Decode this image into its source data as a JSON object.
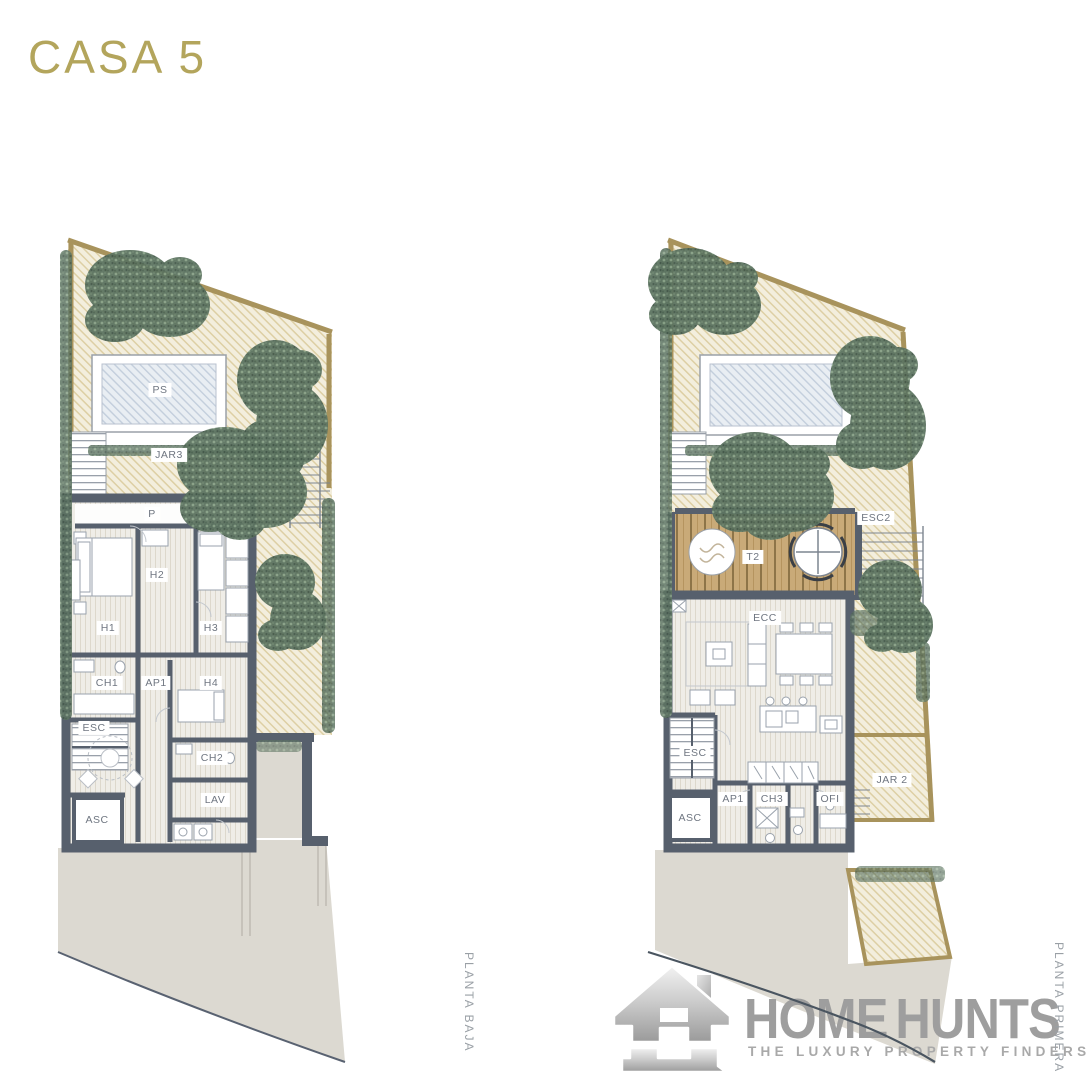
{
  "page": {
    "title": "CASA 5"
  },
  "plans": {
    "left": {
      "caption": "PLANTA BAJA",
      "labels": {
        "ps": "PS",
        "jar3": "JAR3",
        "p": "P",
        "h1": "H1",
        "h2": "H2",
        "h3": "H3",
        "h4": "H4",
        "ch1": "CH1",
        "ap1": "AP1",
        "esc": "ESC",
        "ch2": "CH2",
        "lav": "LAV",
        "asc": "ASC"
      }
    },
    "right": {
      "caption": "PLANTA PRIMERA",
      "labels": {
        "esc2": "ESC2",
        "t2": "T2",
        "ecc": "ECC",
        "esc": "ESC",
        "asc": "ASC",
        "ap1": "AP1",
        "ch3": "CH3",
        "ofi": "OFI",
        "jar2": "JAR 2"
      }
    }
  },
  "branding": {
    "brand_first": "HOME",
    "brand_second": "HUNTS",
    "tagline": "THE LUXURY PROPERTY FINDERS"
  },
  "colors": {
    "title_gold": "#b3a55c",
    "wall": "#57606d",
    "garden_fill": "#f3eedd",
    "garden_hatch": "#d5c491",
    "gold_border": "#a8935c",
    "tree_green": "#5d7461",
    "pool_fill": "#e9eef3",
    "deck_tan": "#c9aa78",
    "floor": "#efede7",
    "driveway": "#dcd9d1",
    "label_text": "#6f7681",
    "logo_gray": "#9e9e9e"
  }
}
